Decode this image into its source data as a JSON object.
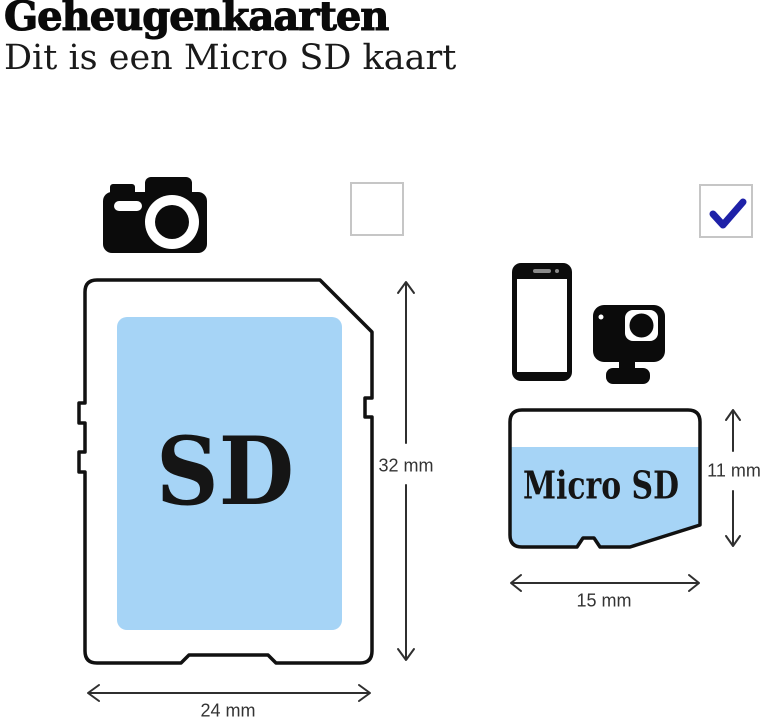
{
  "header": {
    "title": "Geheugenkaarten",
    "subtitle": "Dit is een Micro SD kaart"
  },
  "colors": {
    "card_fill_blue": "#a6d4f6",
    "checkmark_blue": "#1e21a8",
    "outline_black": "#111111",
    "dimension_text": "#333333",
    "checkbox_border": "#c6c6c6"
  },
  "left_panel": {
    "device_icon": "camera-icon",
    "checkbox": {
      "checked": false
    },
    "card": {
      "label": "SD",
      "height": "32 mm",
      "width": "24 mm"
    }
  },
  "right_panel": {
    "device_icons": [
      "smartphone-icon",
      "action-camera-icon"
    ],
    "checkbox": {
      "checked": true
    },
    "card": {
      "label": "Micro SD",
      "height": "11 mm",
      "width": "15 mm"
    }
  }
}
